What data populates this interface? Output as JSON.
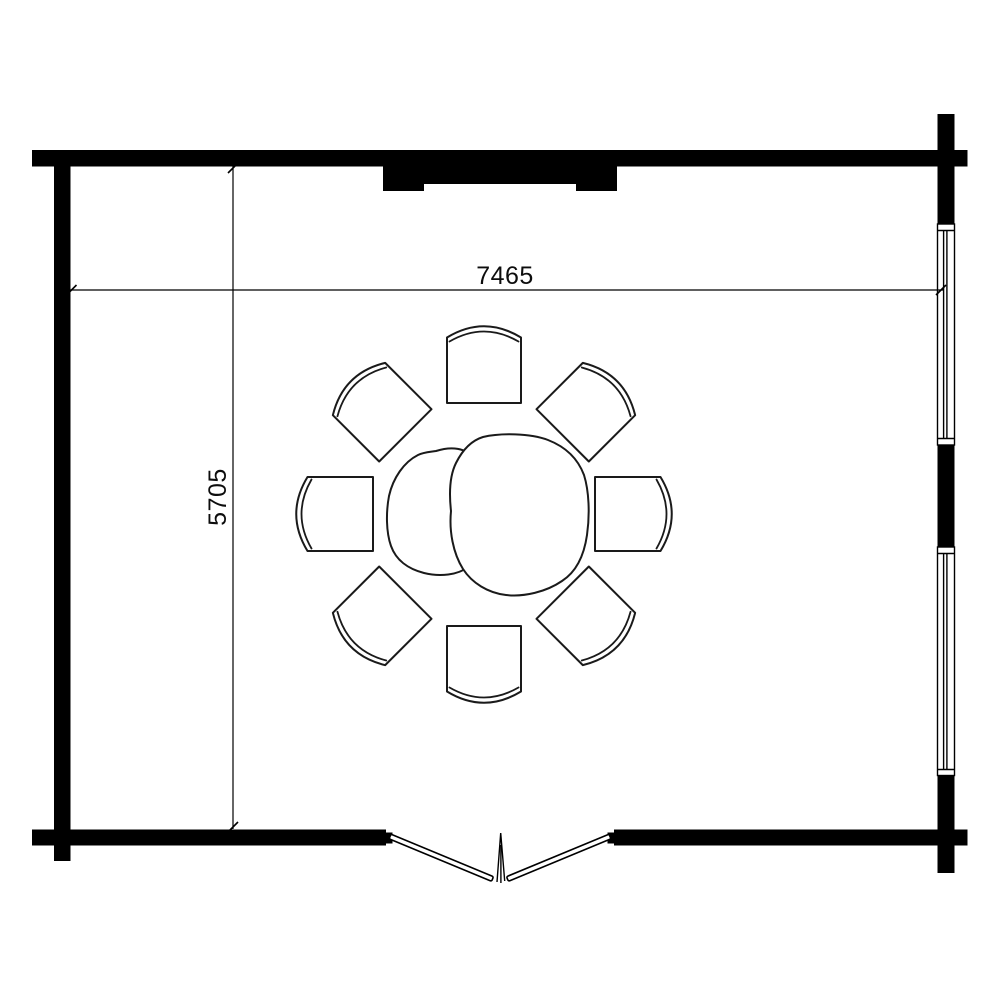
{
  "page": {
    "background_color": "#ffffff",
    "line_color": "#000000"
  },
  "floor_plan": {
    "dimensions": {
      "width_label": "7465",
      "height_label": "5705"
    },
    "features": {
      "door": "double-door-bottom-center",
      "top_opening": "solid-panel-top-center",
      "windows": [
        "right-wall-upper-window",
        "right-wall-lower-window"
      ],
      "furniture": {
        "table": "round-table",
        "chair_count": "8"
      }
    }
  }
}
